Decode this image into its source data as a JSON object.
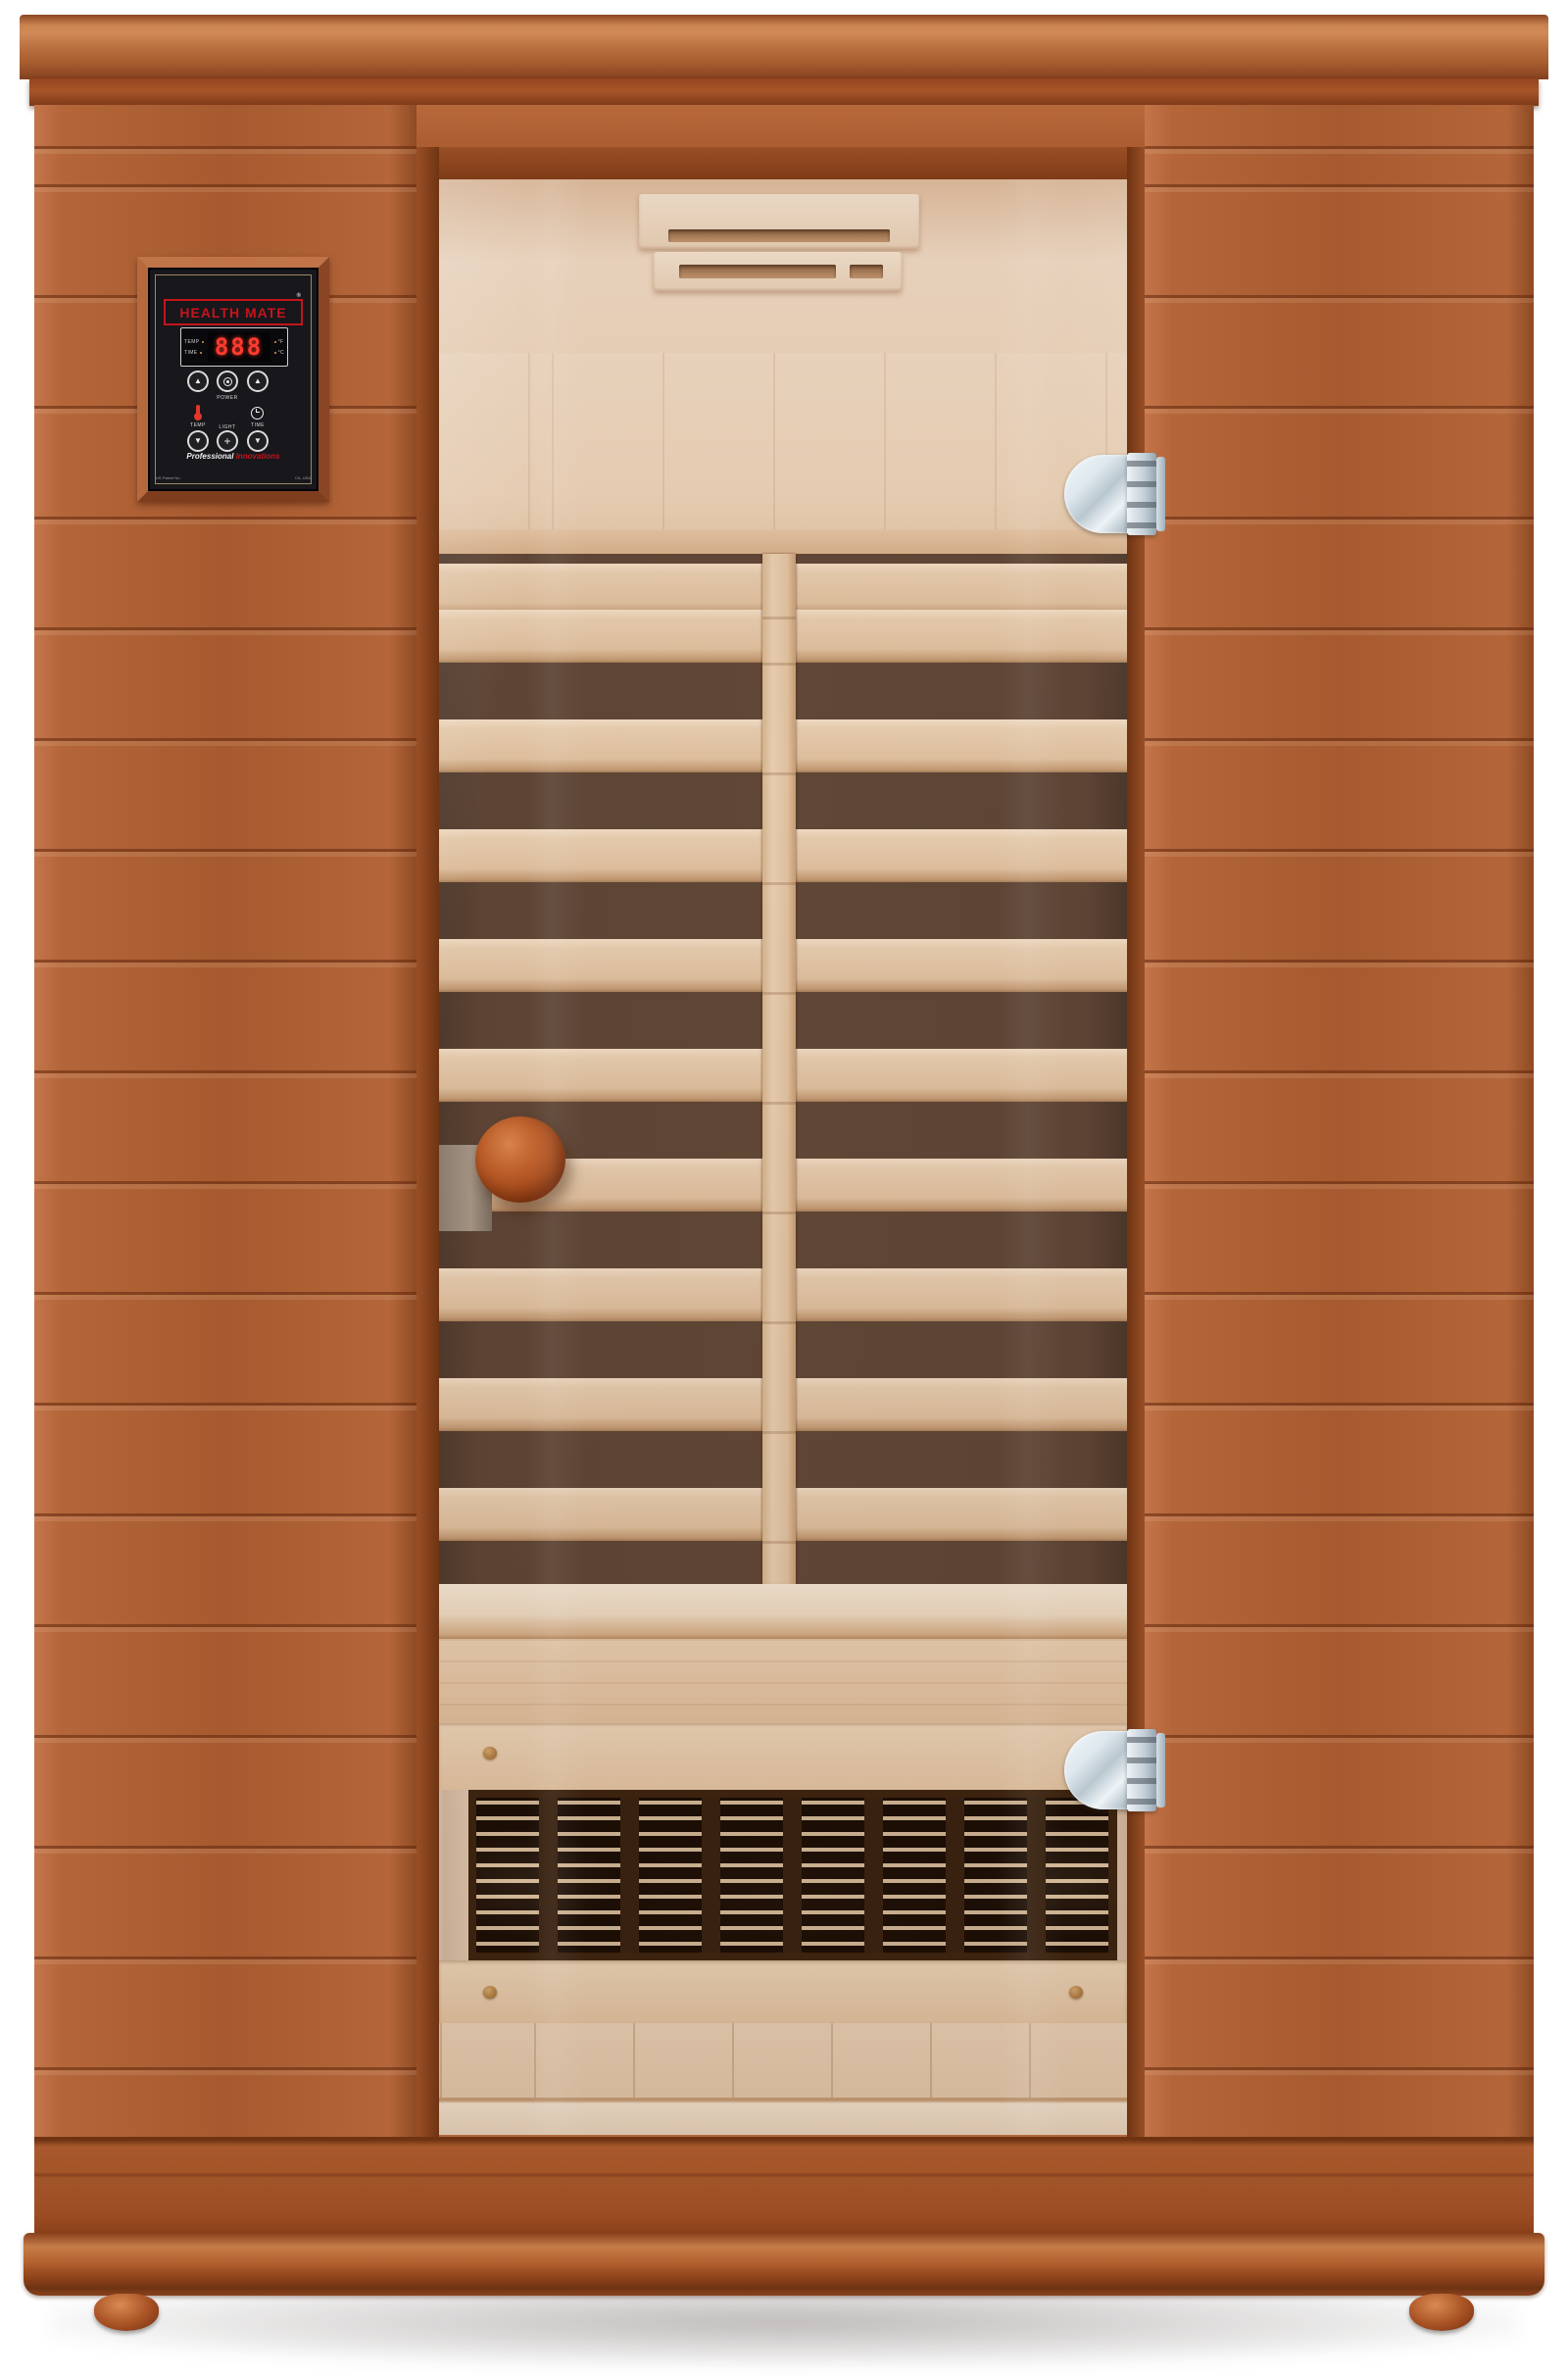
{
  "page": {
    "background": "#ffffff"
  },
  "control_panel": {
    "brand": "HEALTH MATE",
    "registered_mark": "®",
    "display": {
      "temp_label": "TEMP",
      "time_label": "TIME",
      "digits": "888",
      "fahrenheit": "°F",
      "celsius": "°C"
    },
    "buttons": {
      "temp_up": "▲",
      "temp_down": "▼",
      "time_up": "▲",
      "time_down": "▼",
      "power_label": "POWER",
      "temp_label": "TEMP",
      "time_label": "TIME",
      "light_label": "LIGHT",
      "light_symbol": "+"
    },
    "tagline": {
      "white": "Professional",
      "red": "Innovations"
    },
    "fineprint": {
      "left": "US Patent No.",
      "right": "CA, USA"
    }
  },
  "palette": {
    "page_bg": "#ffffff",
    "wood_mid": "#b4663a",
    "wood_light": "#c4754a",
    "wood_dark": "#8f4a24",
    "crown_hi": "#d18a58",
    "crown_dark": "#7e3f1d",
    "door_frame": "#94471f",
    "interior_light": "#f0dcc6",
    "interior_shadow": "#d3ac88",
    "heater_dark": "#5d4536",
    "slat_wood": "#ead0b2",
    "grille_frame": "#38220f",
    "grille_glow": "#ffd7a5",
    "chrome": "#dfe7ec",
    "knob": "#b35422",
    "panel_black": "#17171c",
    "brand_red": "#c4151c",
    "segment_red": "#ff3b30"
  }
}
